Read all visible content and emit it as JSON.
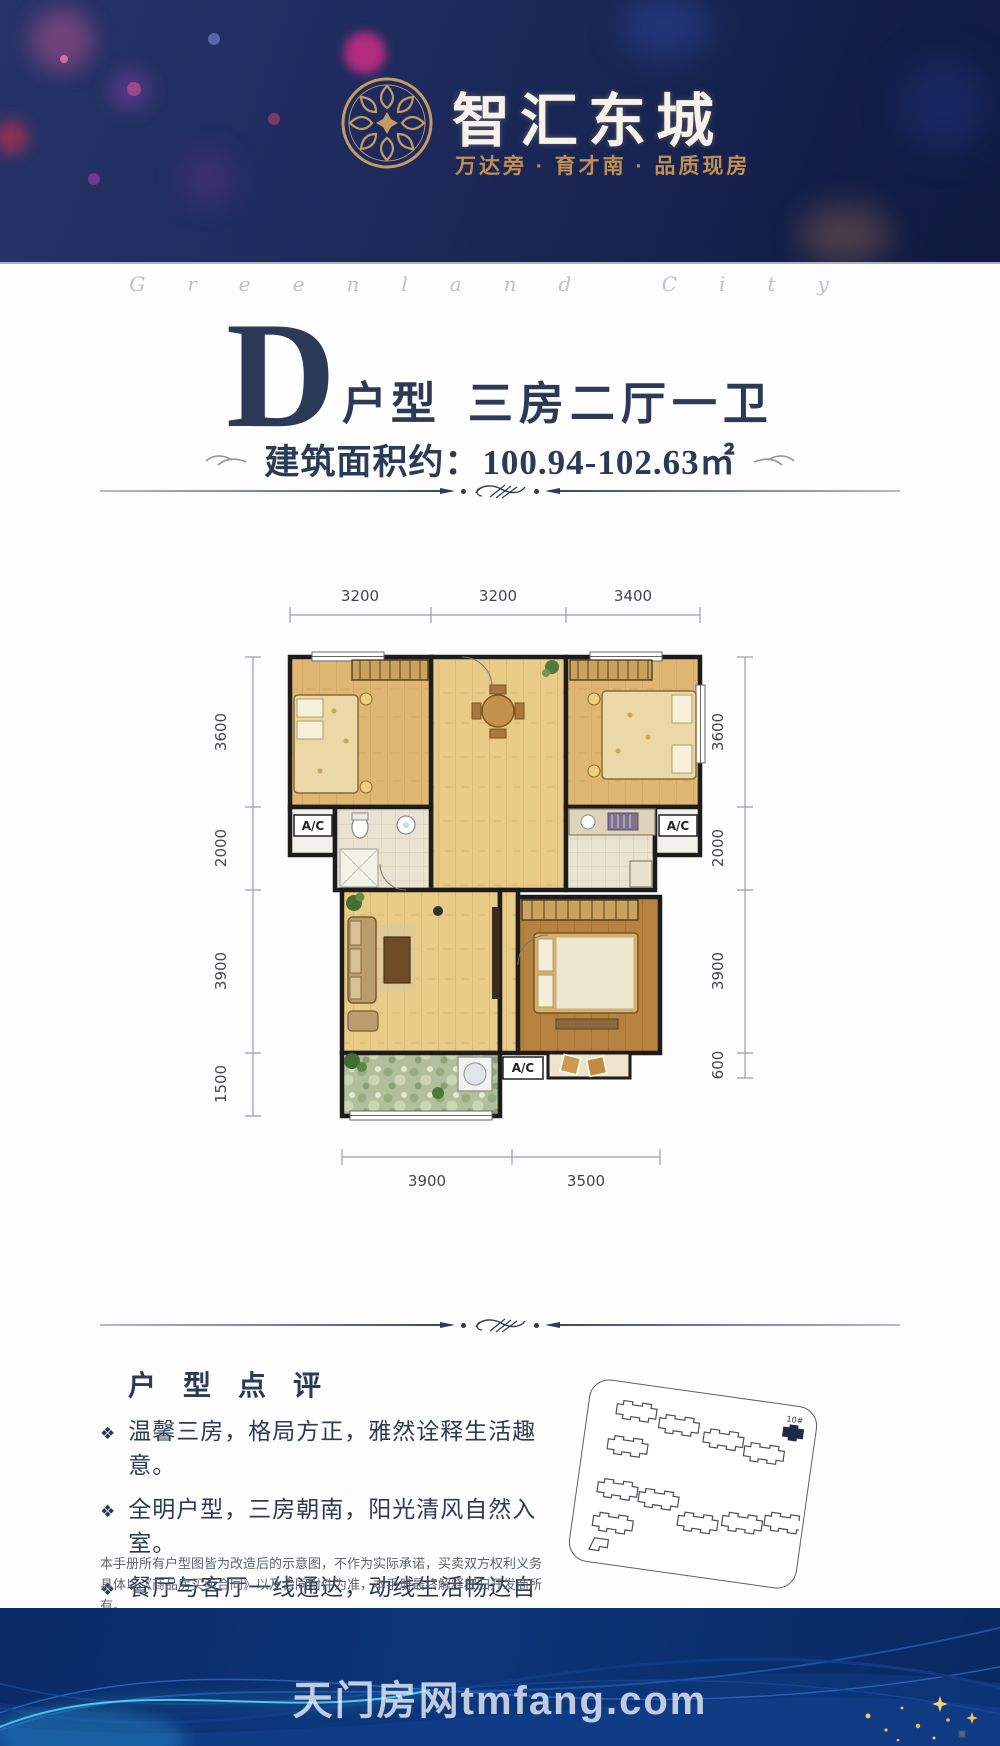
{
  "header": {
    "title": "智汇东城",
    "subtitle": "万达旁 · 育才南 · 品质现房",
    "logo_icon": "medallion-rosette-icon"
  },
  "script_watermark": "Greenland City",
  "unit_title": {
    "letter": "D",
    "type_label": "户型",
    "rooms_label": "三房二厅一卫",
    "area_label": "建筑面积约：",
    "area_value": "100.94-102.63㎡"
  },
  "floorplan": {
    "dims_top": [
      "3200",
      "3200",
      "3400"
    ],
    "dims_left": [
      "3600",
      "2000",
      "3900",
      "1500"
    ],
    "dims_right": [
      "3600",
      "2000",
      "3900",
      "600"
    ],
    "dims_bottom": [
      "3900",
      "3500"
    ],
    "ac_labels": [
      "A/C",
      "A/C",
      "A/C"
    ]
  },
  "review": {
    "heading": "户 型 点 评",
    "bullets": [
      "温馨三房，格局方正，雅然诠释生活趣意。",
      "全明户型，三房朝南，阳光清风自然入室。",
      "餐厅与客厅一线通达，动线生活畅达自如。",
      "客厅、卧室宽敞大方，主人高贵身份不彰自显。"
    ],
    "disclaimer": "本手册所有户型图皆为改造后的示意图，不作为实际承诺，买卖双方权利义务具体以《商品房买卖合同》以及合同附件为准，本手册最终解释权归开发商所有。"
  },
  "siteplan": {
    "highlight_label": "10#"
  },
  "footer": {
    "watermark": "天门房网tmfang.com"
  },
  "colors": {
    "header_navy": "#1d2a5c",
    "gold": "#c59a62",
    "text_navy": "#2c3a57",
    "footer_navy": "#0a2a66"
  }
}
